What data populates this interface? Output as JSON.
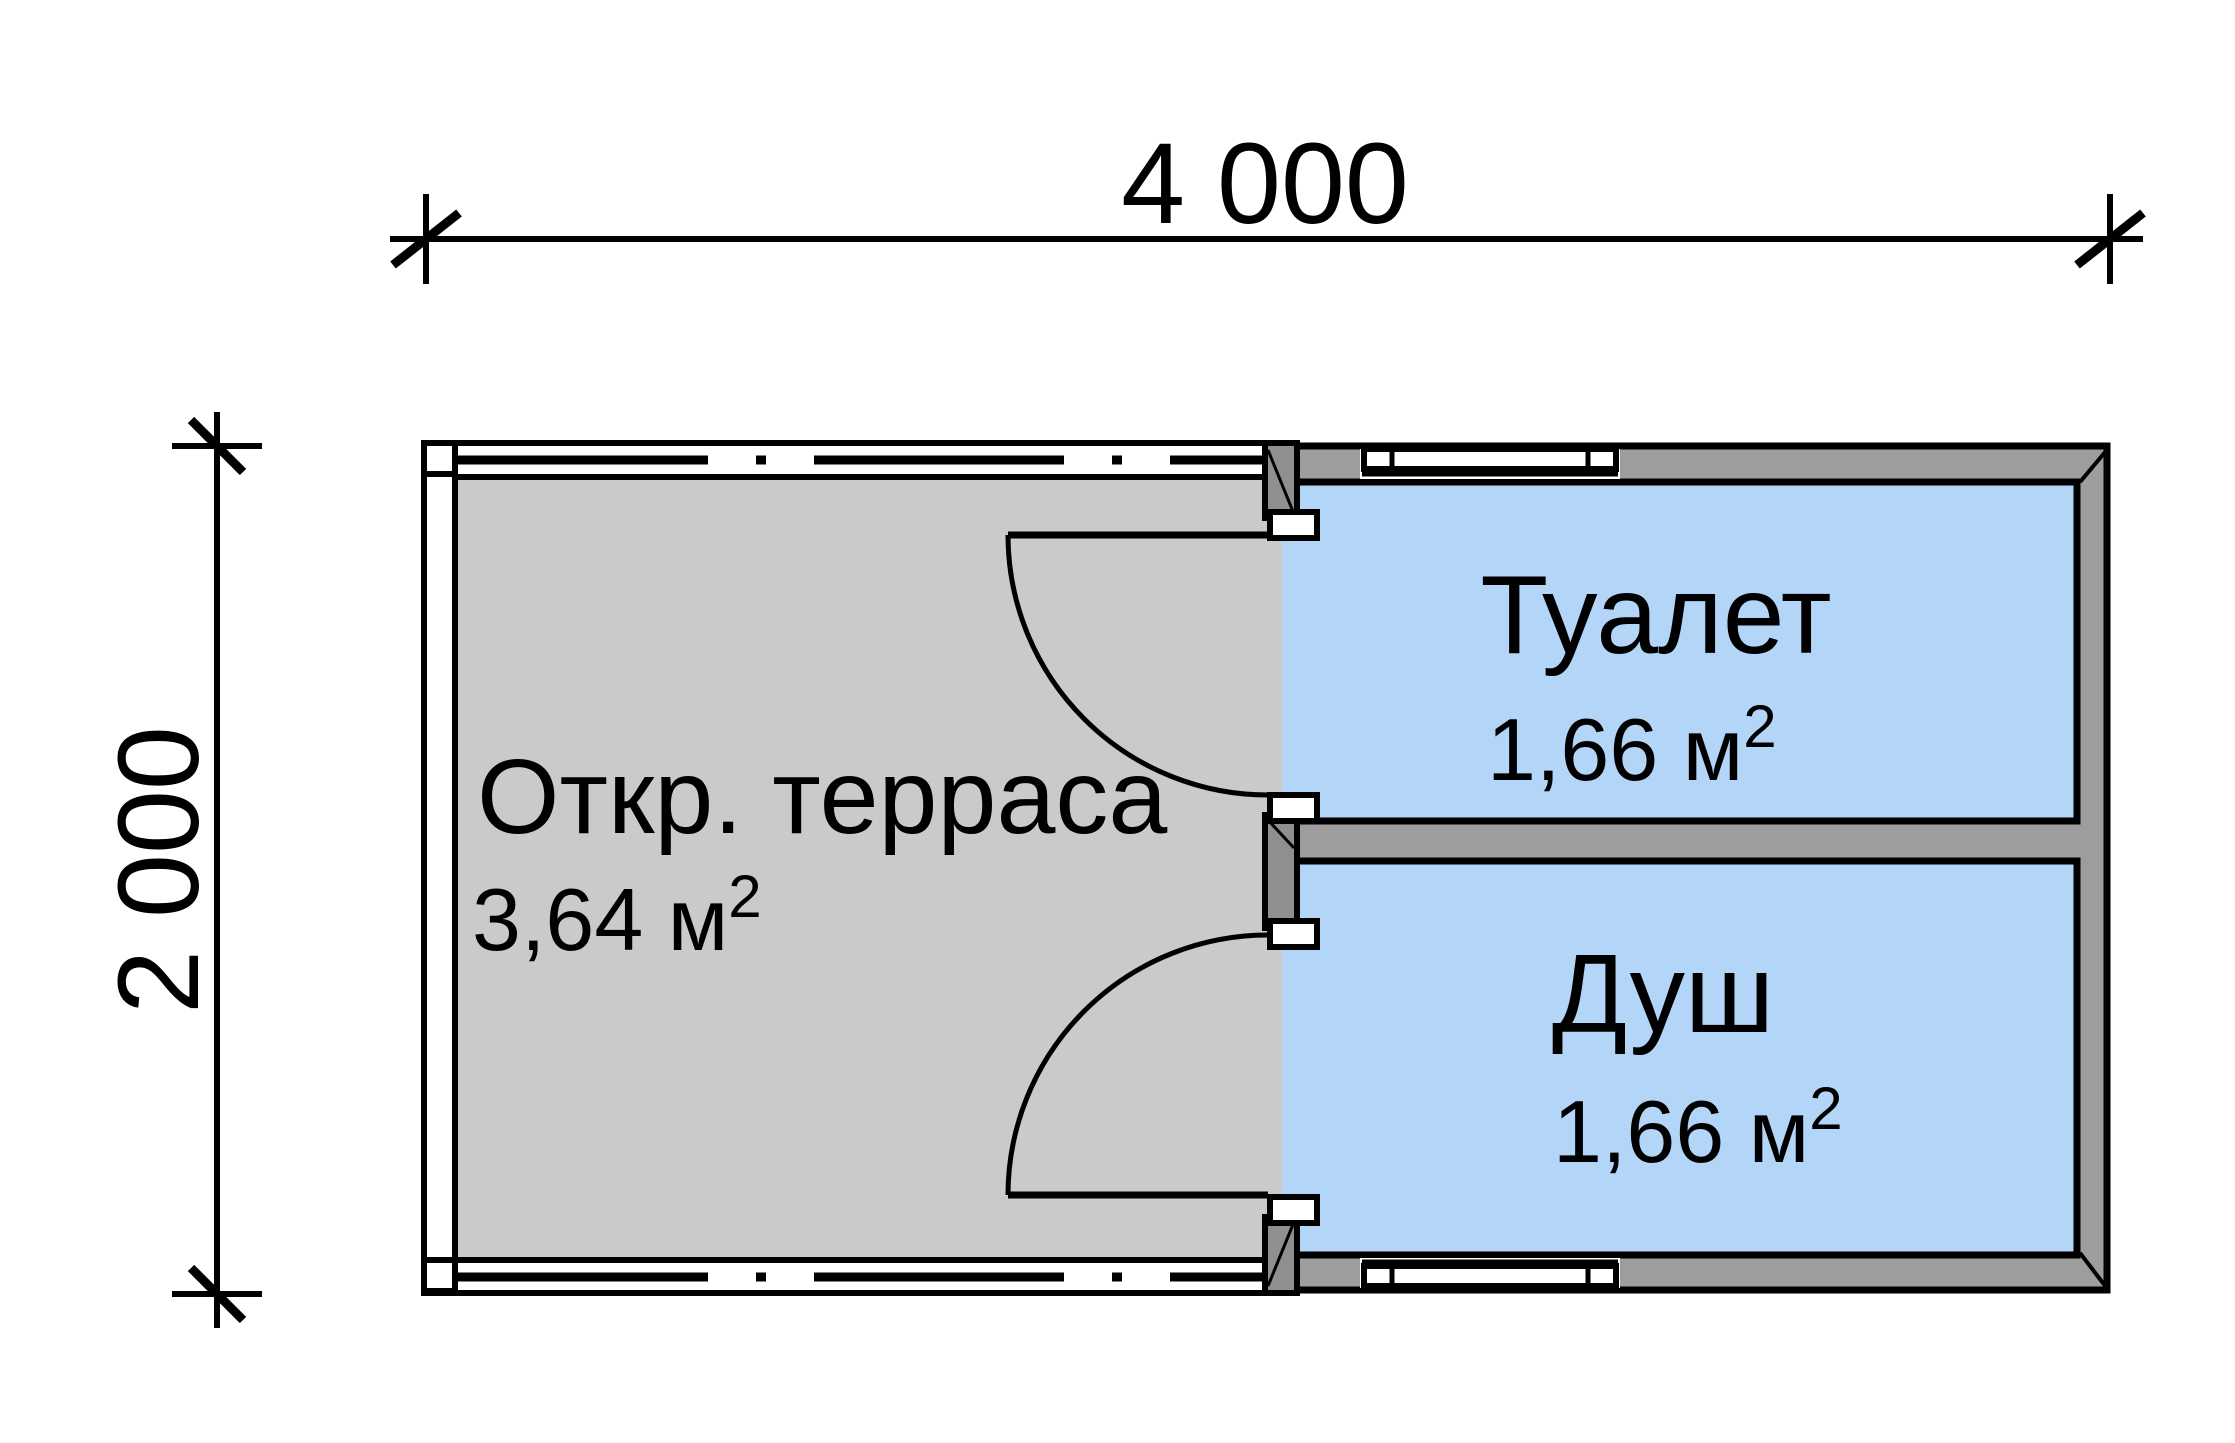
{
  "drawing": {
    "type": "floor-plan",
    "dimensions": {
      "width_label": "4 000",
      "height_label": "2 000"
    },
    "rooms": {
      "terrace": {
        "name": "Откр. терраса",
        "area": "3,64 м",
        "area_sup": "2"
      },
      "toilet": {
        "name": "Туалет",
        "area": "1,66 м",
        "area_sup": "2"
      },
      "shower": {
        "name": "Душ",
        "area": "1,66 м",
        "area_sup": "2"
      }
    },
    "colors": {
      "floor_grey": "#cacaca",
      "wall_grey": "#9d9d9d",
      "wall_dark_grey": "#8f8f8f",
      "room_blue": "#b3d5f7",
      "line_black": "#000000"
    }
  }
}
